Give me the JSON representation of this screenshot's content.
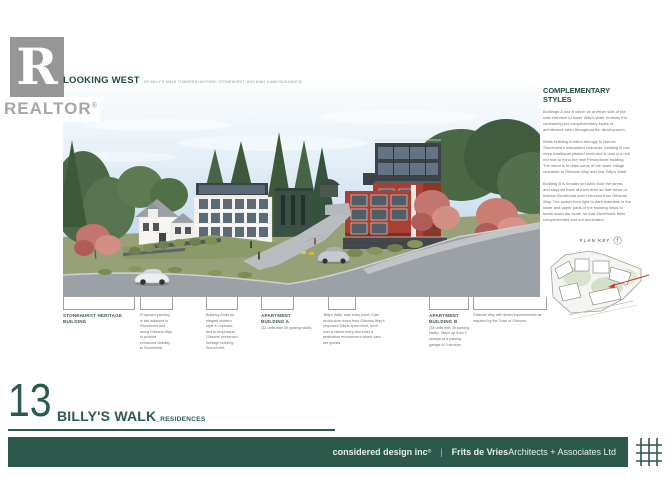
{
  "branding": {
    "realtor_letter": "R",
    "realtor_text": "REALTOR",
    "realtor_reg": "®"
  },
  "header": {
    "title": "LOOKING WEST",
    "subtitle": "OF BILLY'S WALK TOWARDS HISTORIC STONEHURST, BUILDING A AND BUILDING B"
  },
  "styles_panel": {
    "heading": "COMPLEMENTARY STYLES",
    "paragraphs": {
      "p1": "Buildings A and B which sit at either side of the east entrance to lower 'Billy's Walk' embody the contrasting yet complementary styles of architecture seen throughout the development.",
      "p2": "While building A refers strongly to historic Stonehurst's articulated character, building B has more traditional pitched roofs and is clad in a rich red hue to echo the new Persephone building. The intent is to draw some of the lower village character to Gibsons Way and into 'Billy's Walk'.",
      "p3": "Building B is broadly set back from the street, and stepped back at each level so that views of historic Stonehurst aren't blocked from Gibsons Way. The switch from light to dark materials in the lower and upper parts of the building helps to break down the scale, so that Stonehurst feels complemented and not dominated."
    }
  },
  "plan_key": {
    "label": "PLAN KEY"
  },
  "annotations": [
    {
      "label": "STONEHURST HERITAGE BUILDING",
      "text": ""
    },
    {
      "label": "",
      "text": "Proposed planting is low adjacent to Stonehurst and along Gibsons Way, to provide enhanced visibility to Stonehurst."
    },
    {
      "label": "",
      "text": "Building A has an elegant modern style in contrast, and to emphasize Gibsons' preserved heritage building: Stonehurst."
    },
    {
      "label": "APARTMENT BUILDING A",
      "text": "(32 units with 39 parking stalls)"
    },
    {
      "label": "",
      "text": "'Billy's Walk' east entry point. Cars would slow down from Gibsons Way's proposed 30kph speed limit, drive over a raised entry and enter a pedestrian environment where cars are guests."
    },
    {
      "label": "APARTMENT BUILDING B",
      "text": "(35 units with 39 parking stalls). Steps up from 2 storeys at a parking garage to 4 storeys."
    },
    {
      "label": "",
      "text": "Gibsons Way with street improvements as required by the Town of Gibsons."
    }
  ],
  "title_block": {
    "sheet_number": "13",
    "project": "BILLY'S WALK",
    "suffix": "_RESIDENCES"
  },
  "footer": {
    "firm1": "considered design inc",
    "firm1_reg": "®",
    "divider": "|",
    "firm2_bold": "Frits de Vries",
    "firm2_rest": " Architects + Associates Ltd"
  },
  "colors": {
    "accent_teal": "#2d5a4e",
    "footer_green": "#2d594d",
    "building_b_red": "#a84134",
    "sky_blue": "#bed7ea",
    "plan_arrow_red": "#c13a2d",
    "logo_gray": "#969696"
  }
}
